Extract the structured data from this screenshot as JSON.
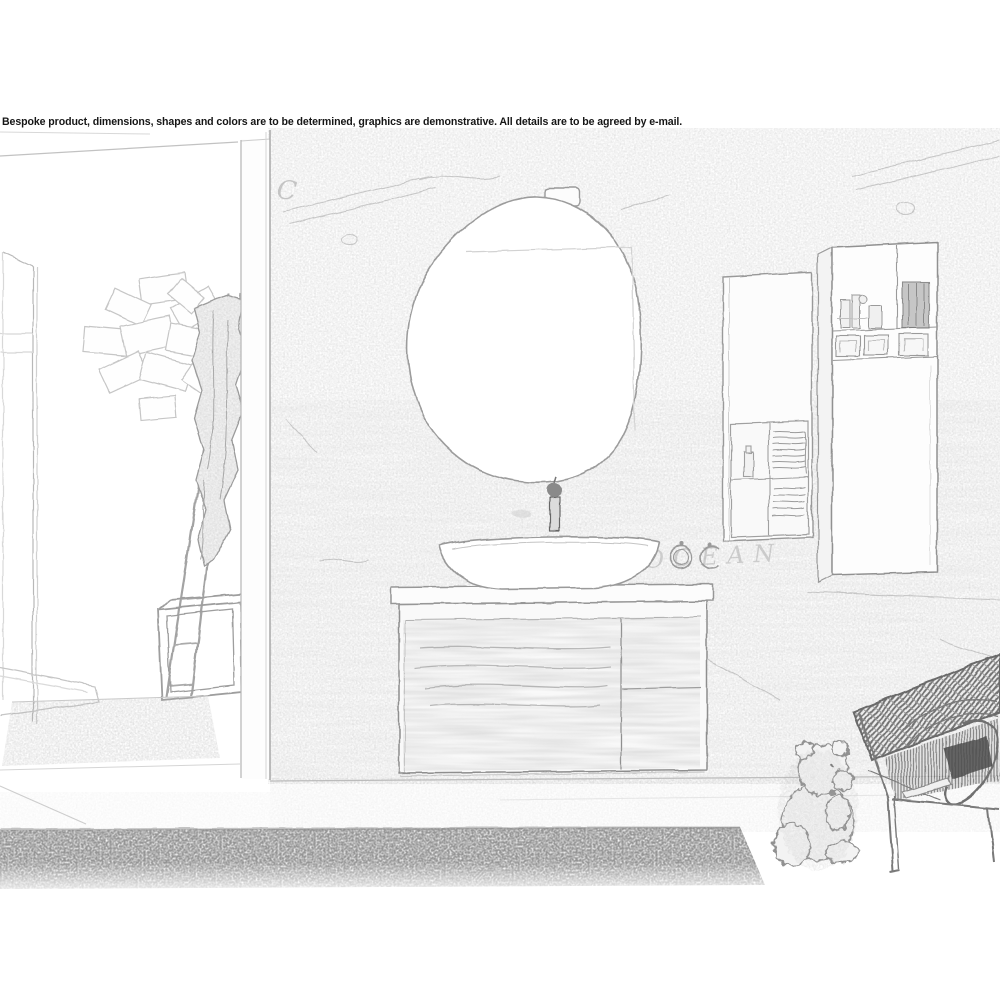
{
  "disclaimer": "Bespoke product, dimensions, shapes and colors are to be determined, graphics are demonstrative. All details are to be agreed by e-mail.",
  "wall_graffiti": {
    "letter": "C",
    "word": "OCEAN"
  },
  "colors": {
    "background": "#ffffff",
    "sketch_line": "#9a9a9a",
    "sketch_dark": "#5a5a5a",
    "texture_gray": "#c8c8c8"
  },
  "scene_objects": [
    "brick-wall",
    "partition-wall",
    "pebble-mirror",
    "mirror-light",
    "vessel-sink",
    "tall-faucet",
    "floating-vanity",
    "towel-rings",
    "wall-cabinet-short",
    "wall-cabinet-tall",
    "ladder-with-towel",
    "frame-stool",
    "leaning-mirror",
    "wall-art-rectangles",
    "wicker-chair",
    "teddy-bear",
    "dark-rug",
    "light-rug"
  ]
}
